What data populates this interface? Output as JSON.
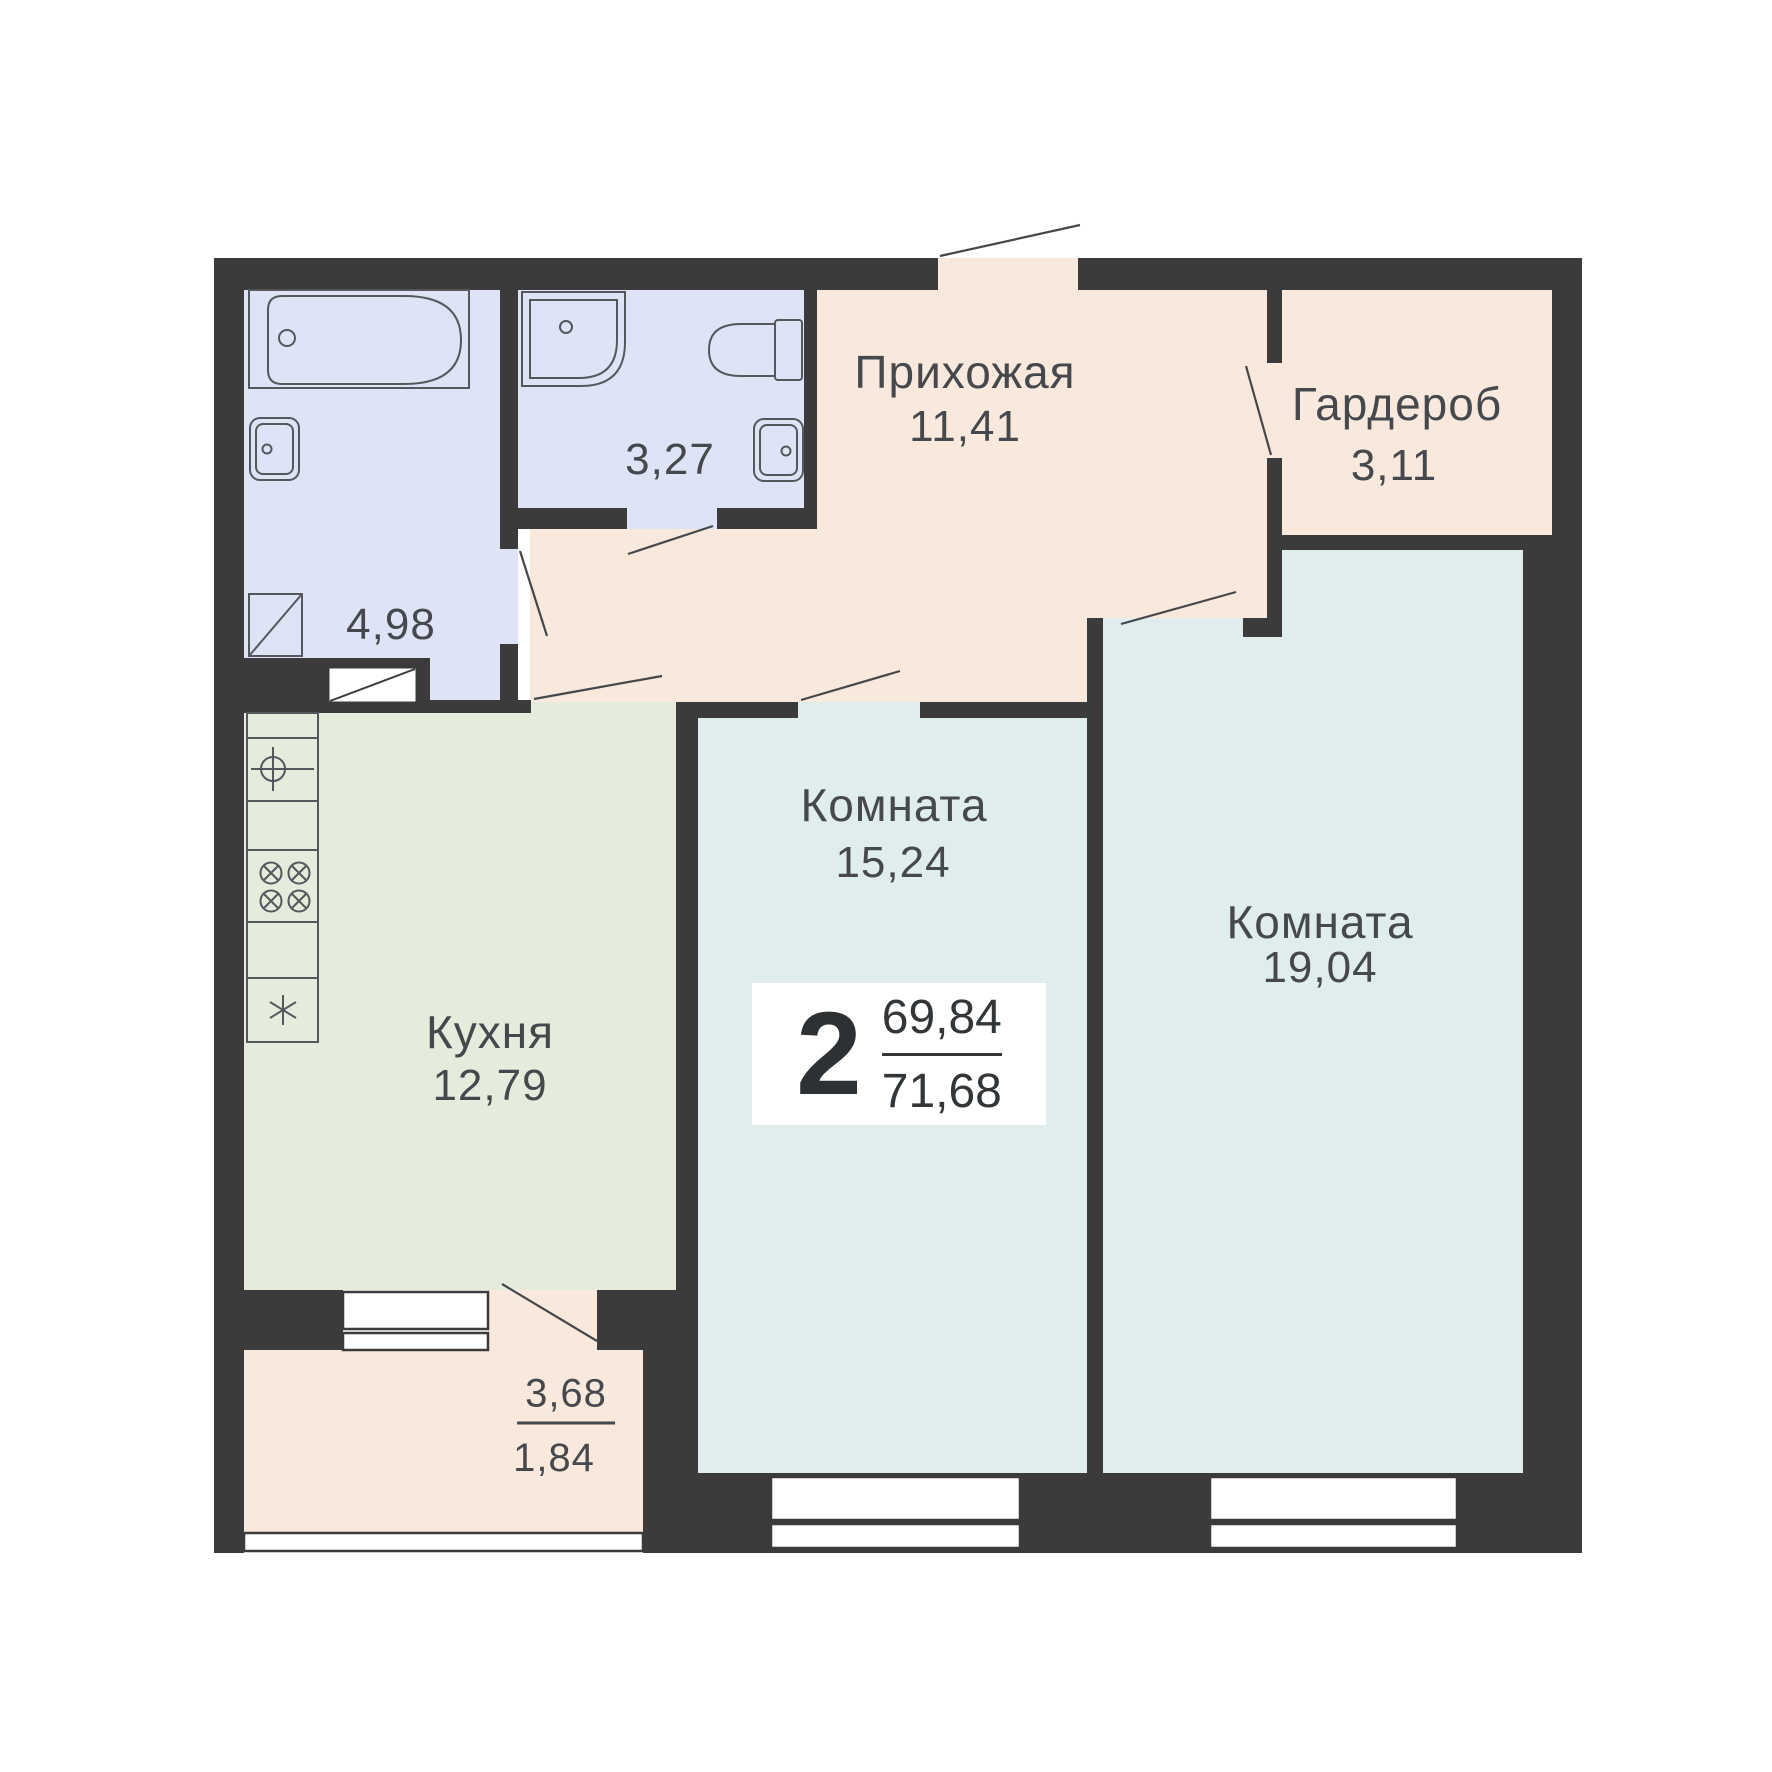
{
  "plan": {
    "rooms_count": "2",
    "area_upper": "69,84",
    "area_lower": "71,68"
  },
  "rooms": {
    "hallway": {
      "name": "Прихожая",
      "area": "11,41"
    },
    "wardrobe": {
      "name": "Гардероб",
      "area": "3,11"
    },
    "bathroom": {
      "area": "4,98"
    },
    "toilet": {
      "area": "3,27"
    },
    "kitchen": {
      "name": "Кухня",
      "area": "12,79"
    },
    "room_1": {
      "name": "Комната",
      "area": "15,24"
    },
    "room_2": {
      "name": "Комната",
      "area": "19,04"
    },
    "balcony": {
      "area_full": "3,68",
      "area_reduced": "1,84"
    }
  },
  "icons": [
    "bathtub-icon",
    "bath-sink-icon",
    "washing-machine-icon",
    "shower-icon",
    "toilet-icon",
    "wc-sink-icon",
    "kitchen-sink-icon",
    "stove-icon",
    "fridge-icon",
    "door-swing-icon",
    "window-icon",
    "vent-shaft-icon",
    "balcony-glazing-icon"
  ],
  "colors": {
    "wall": "#3b3b3b",
    "wet_room_fill": "#dee4f6",
    "hallway_fill": "#f9e9dc",
    "kitchen_fill": "#e6ecdc",
    "living_room_fill": "#e0eded",
    "canvas": "#ffffff",
    "text": "#45494d"
  }
}
